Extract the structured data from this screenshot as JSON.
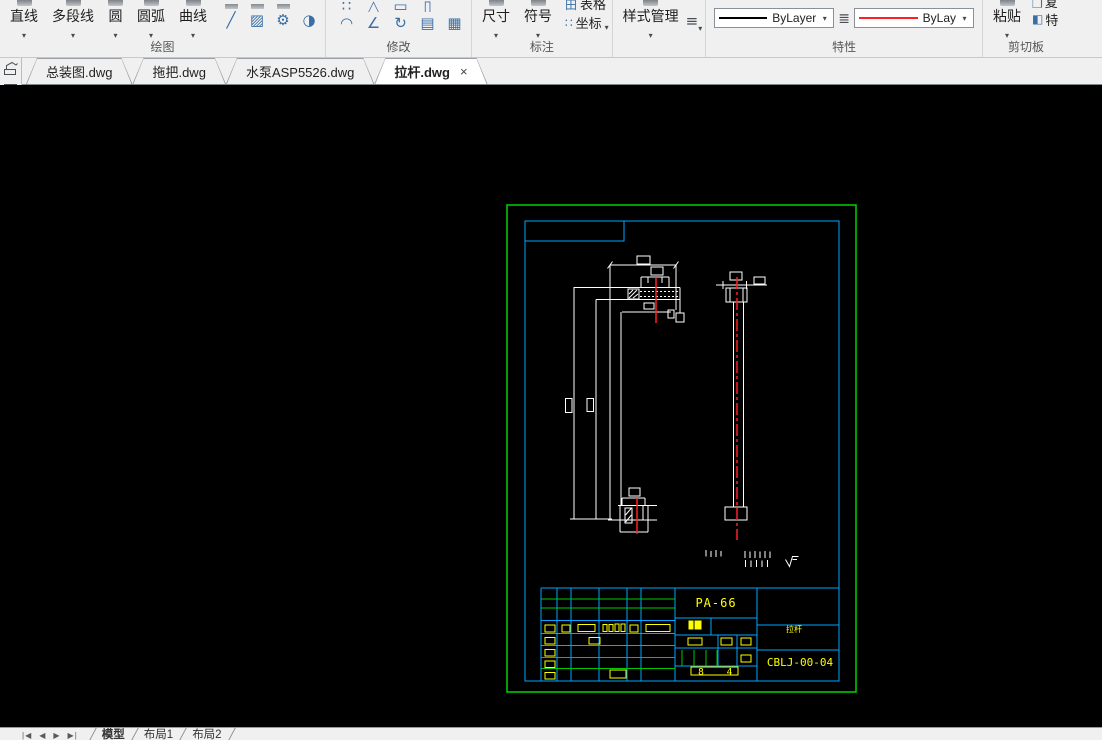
{
  "ribbon": {
    "draw": {
      "label": "绘图",
      "line": "直线",
      "polyline": "多段线",
      "circle": "圆",
      "arc": "圆弧",
      "curve": "曲线"
    },
    "modify": {
      "label": "修改"
    },
    "annotate": {
      "label": "标注",
      "dimension": "尺寸",
      "symbol": "符号",
      "table": "表格",
      "coordinate": "坐标"
    },
    "style": {
      "manager": "样式管理"
    },
    "properties": {
      "label": "特性",
      "linetype_black": "ByLayer",
      "linetype_red": "ByLay"
    },
    "clipboard": {
      "label": "剪切板",
      "paste": "粘贴",
      "copy_partial": "复",
      "match_partial": "特"
    },
    "icons": {
      "spline": "╱",
      "hatch": "▨",
      "gear": "⚙",
      "pie": "◑",
      "scatter": "∷",
      "mirror": "△",
      "rect": "▭",
      "rect2": "▯",
      "fillet": "◠",
      "chamfer": "∠",
      "rotate": "↻",
      "array": "▤",
      "gradient": "▦",
      "table_grid": "田",
      "coord_grid": "∷",
      "menu": "≡",
      "lineweight": "≣",
      "copy": "❐",
      "brush": "◧"
    }
  },
  "doc_tabs": {
    "tab1": "总装图.dwg",
    "tab2": "拖把.dwg",
    "tab3": "水泵ASP5526.dwg",
    "tab4": "拉杆.dwg"
  },
  "titleblock": {
    "material": "PA-66",
    "part_name": "拉杆",
    "drawing_no": "CBLJ-00-04",
    "sheet_num_left": "8",
    "sheet_num_right": "4"
  },
  "statusbar": {
    "model": "模型",
    "layout1": "布局1",
    "layout2": "布局2",
    "nav_first": "|◀",
    "nav_prev": "◀",
    "nav_next": "▶",
    "nav_last": "▶|"
  },
  "colors": {
    "frame_green": "#00d400",
    "frame_cyan": "#00a6ff",
    "table_green": "#00c800",
    "annotation_yellow": "#ffff00",
    "geometry_white": "#ffffff",
    "centerline_red": "#ff2020"
  }
}
